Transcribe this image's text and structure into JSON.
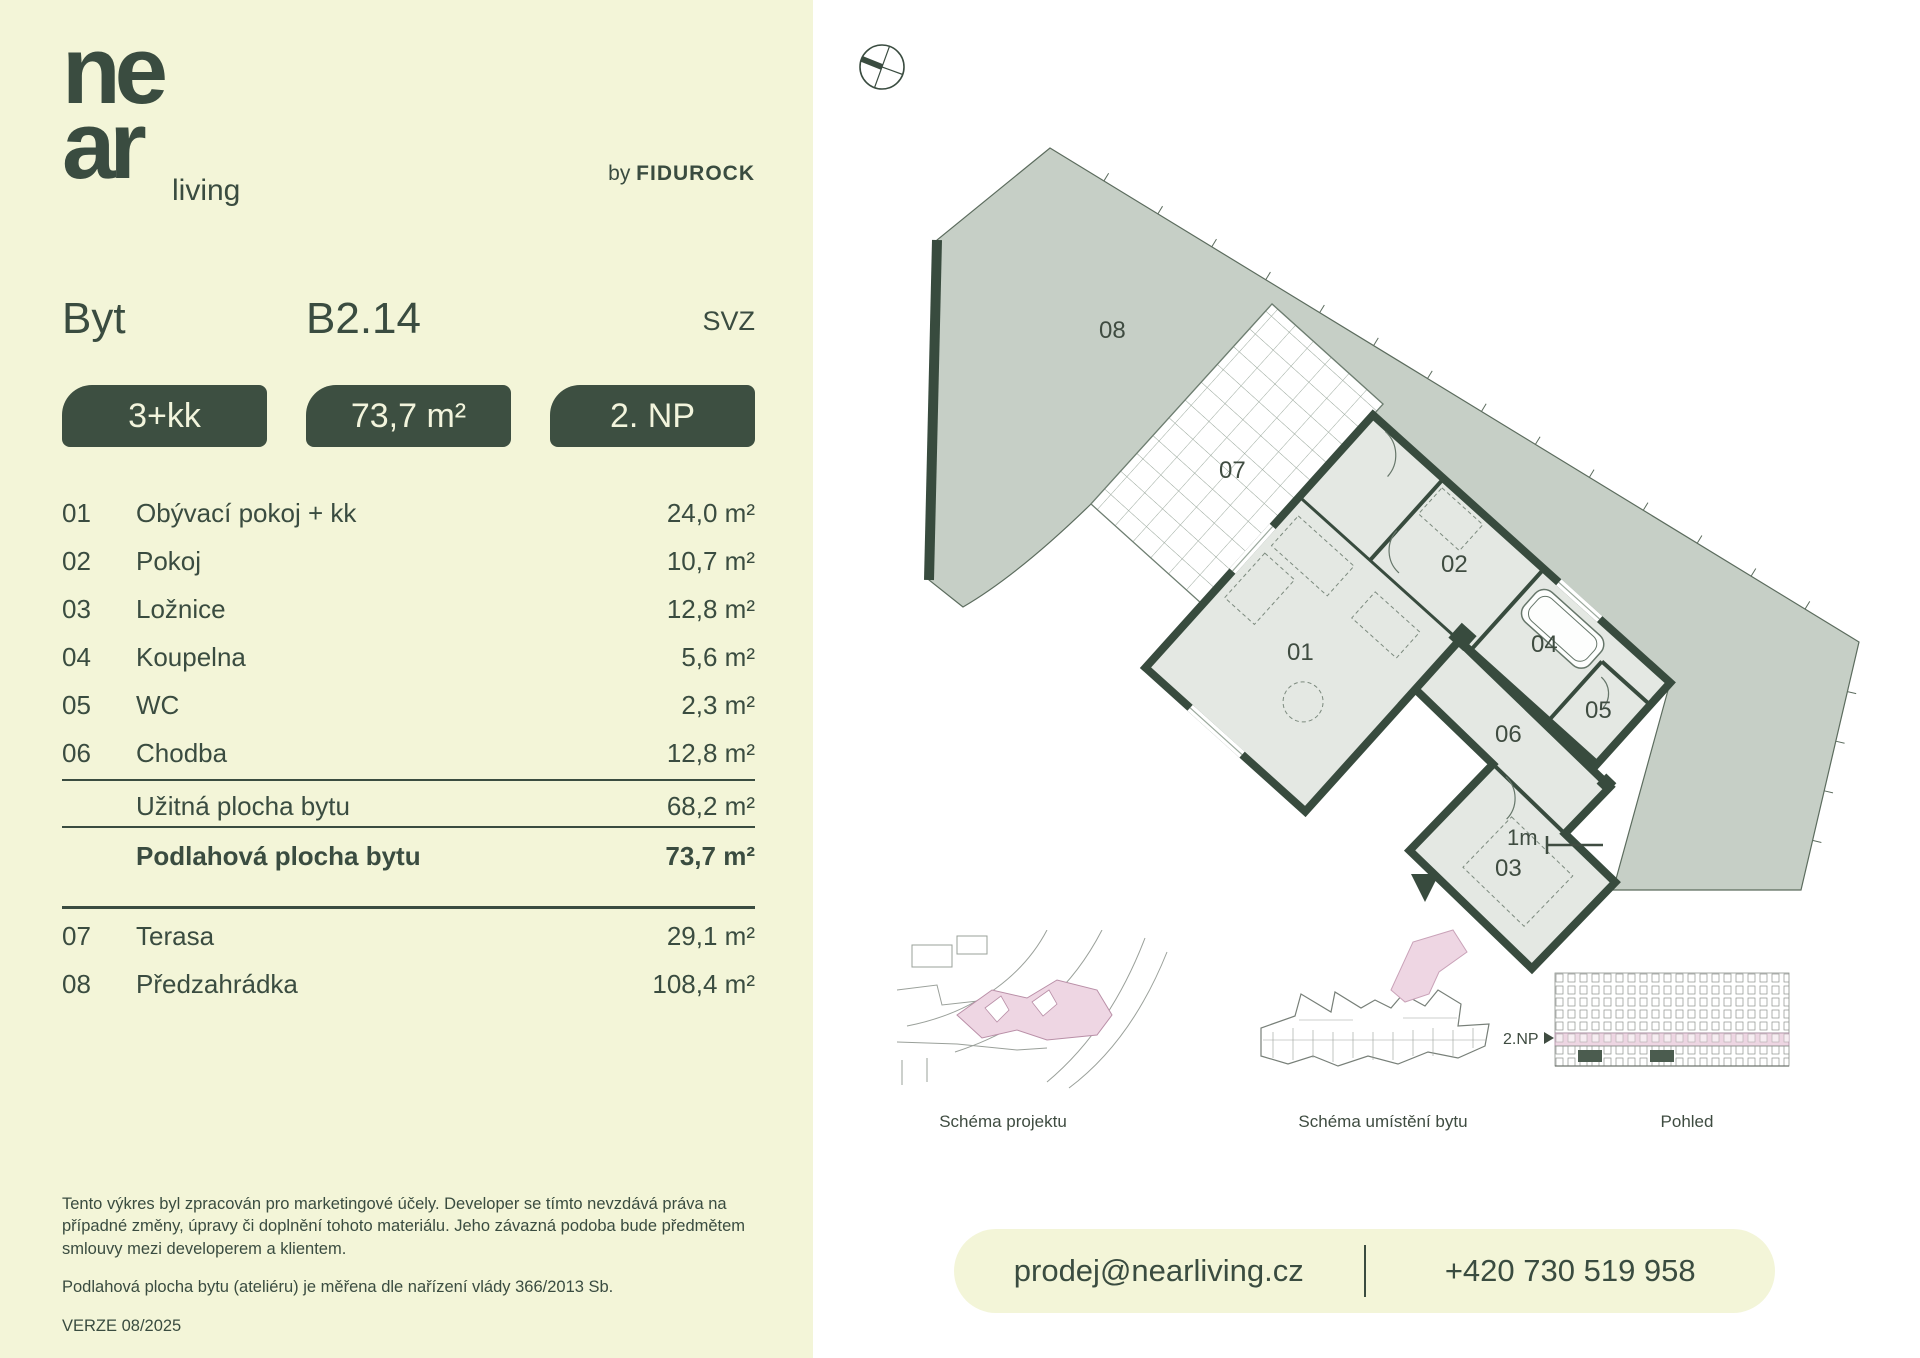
{
  "brand": {
    "logo_line1": "ne",
    "logo_line2": "ar",
    "logo_suffix": "living",
    "by_prefix": "by ",
    "by_name": "FIDUROCK"
  },
  "header": {
    "type_label": "Byt",
    "unit_id": "B2.14",
    "orientation": "SVZ"
  },
  "badges": {
    "layout": "3+kk",
    "area": "73,7 m²",
    "floor": "2. NP"
  },
  "rooms": [
    {
      "num": "01",
      "name": "Obývací pokoj + kk",
      "area": "24,0 m²"
    },
    {
      "num": "02",
      "name": "Pokoj",
      "area": "10,7 m²"
    },
    {
      "num": "03",
      "name": "Ložnice",
      "area": "12,8 m²"
    },
    {
      "num": "04",
      "name": "Koupelna",
      "area": "5,6 m²"
    },
    {
      "num": "05",
      "name": "WC",
      "area": "2,3 m²"
    },
    {
      "num": "06",
      "name": "Chodba",
      "area": "12,8 m²"
    }
  ],
  "summary": {
    "usable_label": "Užitná plocha bytu",
    "usable_area": "68,2 m²",
    "floor_label": "Podlahová plocha bytu",
    "floor_area": "73,7 m²"
  },
  "outdoor": [
    {
      "num": "07",
      "name": "Terasa",
      "area": "29,1 m²"
    },
    {
      "num": "08",
      "name": "Předzahrádka",
      "area": "108,4 m²"
    }
  ],
  "disclaimer": {
    "p1": "Tento výkres byl zpracován pro marketingové účely. Developer se tímto nevzdává práva na případné změny, úpravy či doplnění tohoto materiálu. Jeho závazná podoba bude předmětem smlouvy mezi developerem a klientem.",
    "p2": "Podlahová plocha bytu (ateliéru) je měřena dle nařízení vlády 366/2013 Sb.",
    "version": "VERZE 08/2025"
  },
  "plan": {
    "labels": {
      "r01": "01",
      "r02": "02",
      "r03": "03",
      "r04": "04",
      "r05": "05",
      "r06": "06",
      "r07": "07",
      "r08": "08"
    },
    "scale_label": "1m"
  },
  "thumbnails": {
    "project_label": "Schéma projektu",
    "unit_label": "Schéma umístění bytu",
    "elevation_label": "Pohled",
    "floor_marker": "2.NP"
  },
  "contact": {
    "email": "prodej@nearliving.cz",
    "phone": "+420 730 519 958"
  },
  "colors": {
    "cream": "#f3f5d8",
    "green": "#3a4c40",
    "badge_green": "#3d4f41",
    "garden": "#c6cfc6",
    "room_fill": "#e4e8e3",
    "wall": "#384b3e",
    "pink": "#eed6e3"
  }
}
